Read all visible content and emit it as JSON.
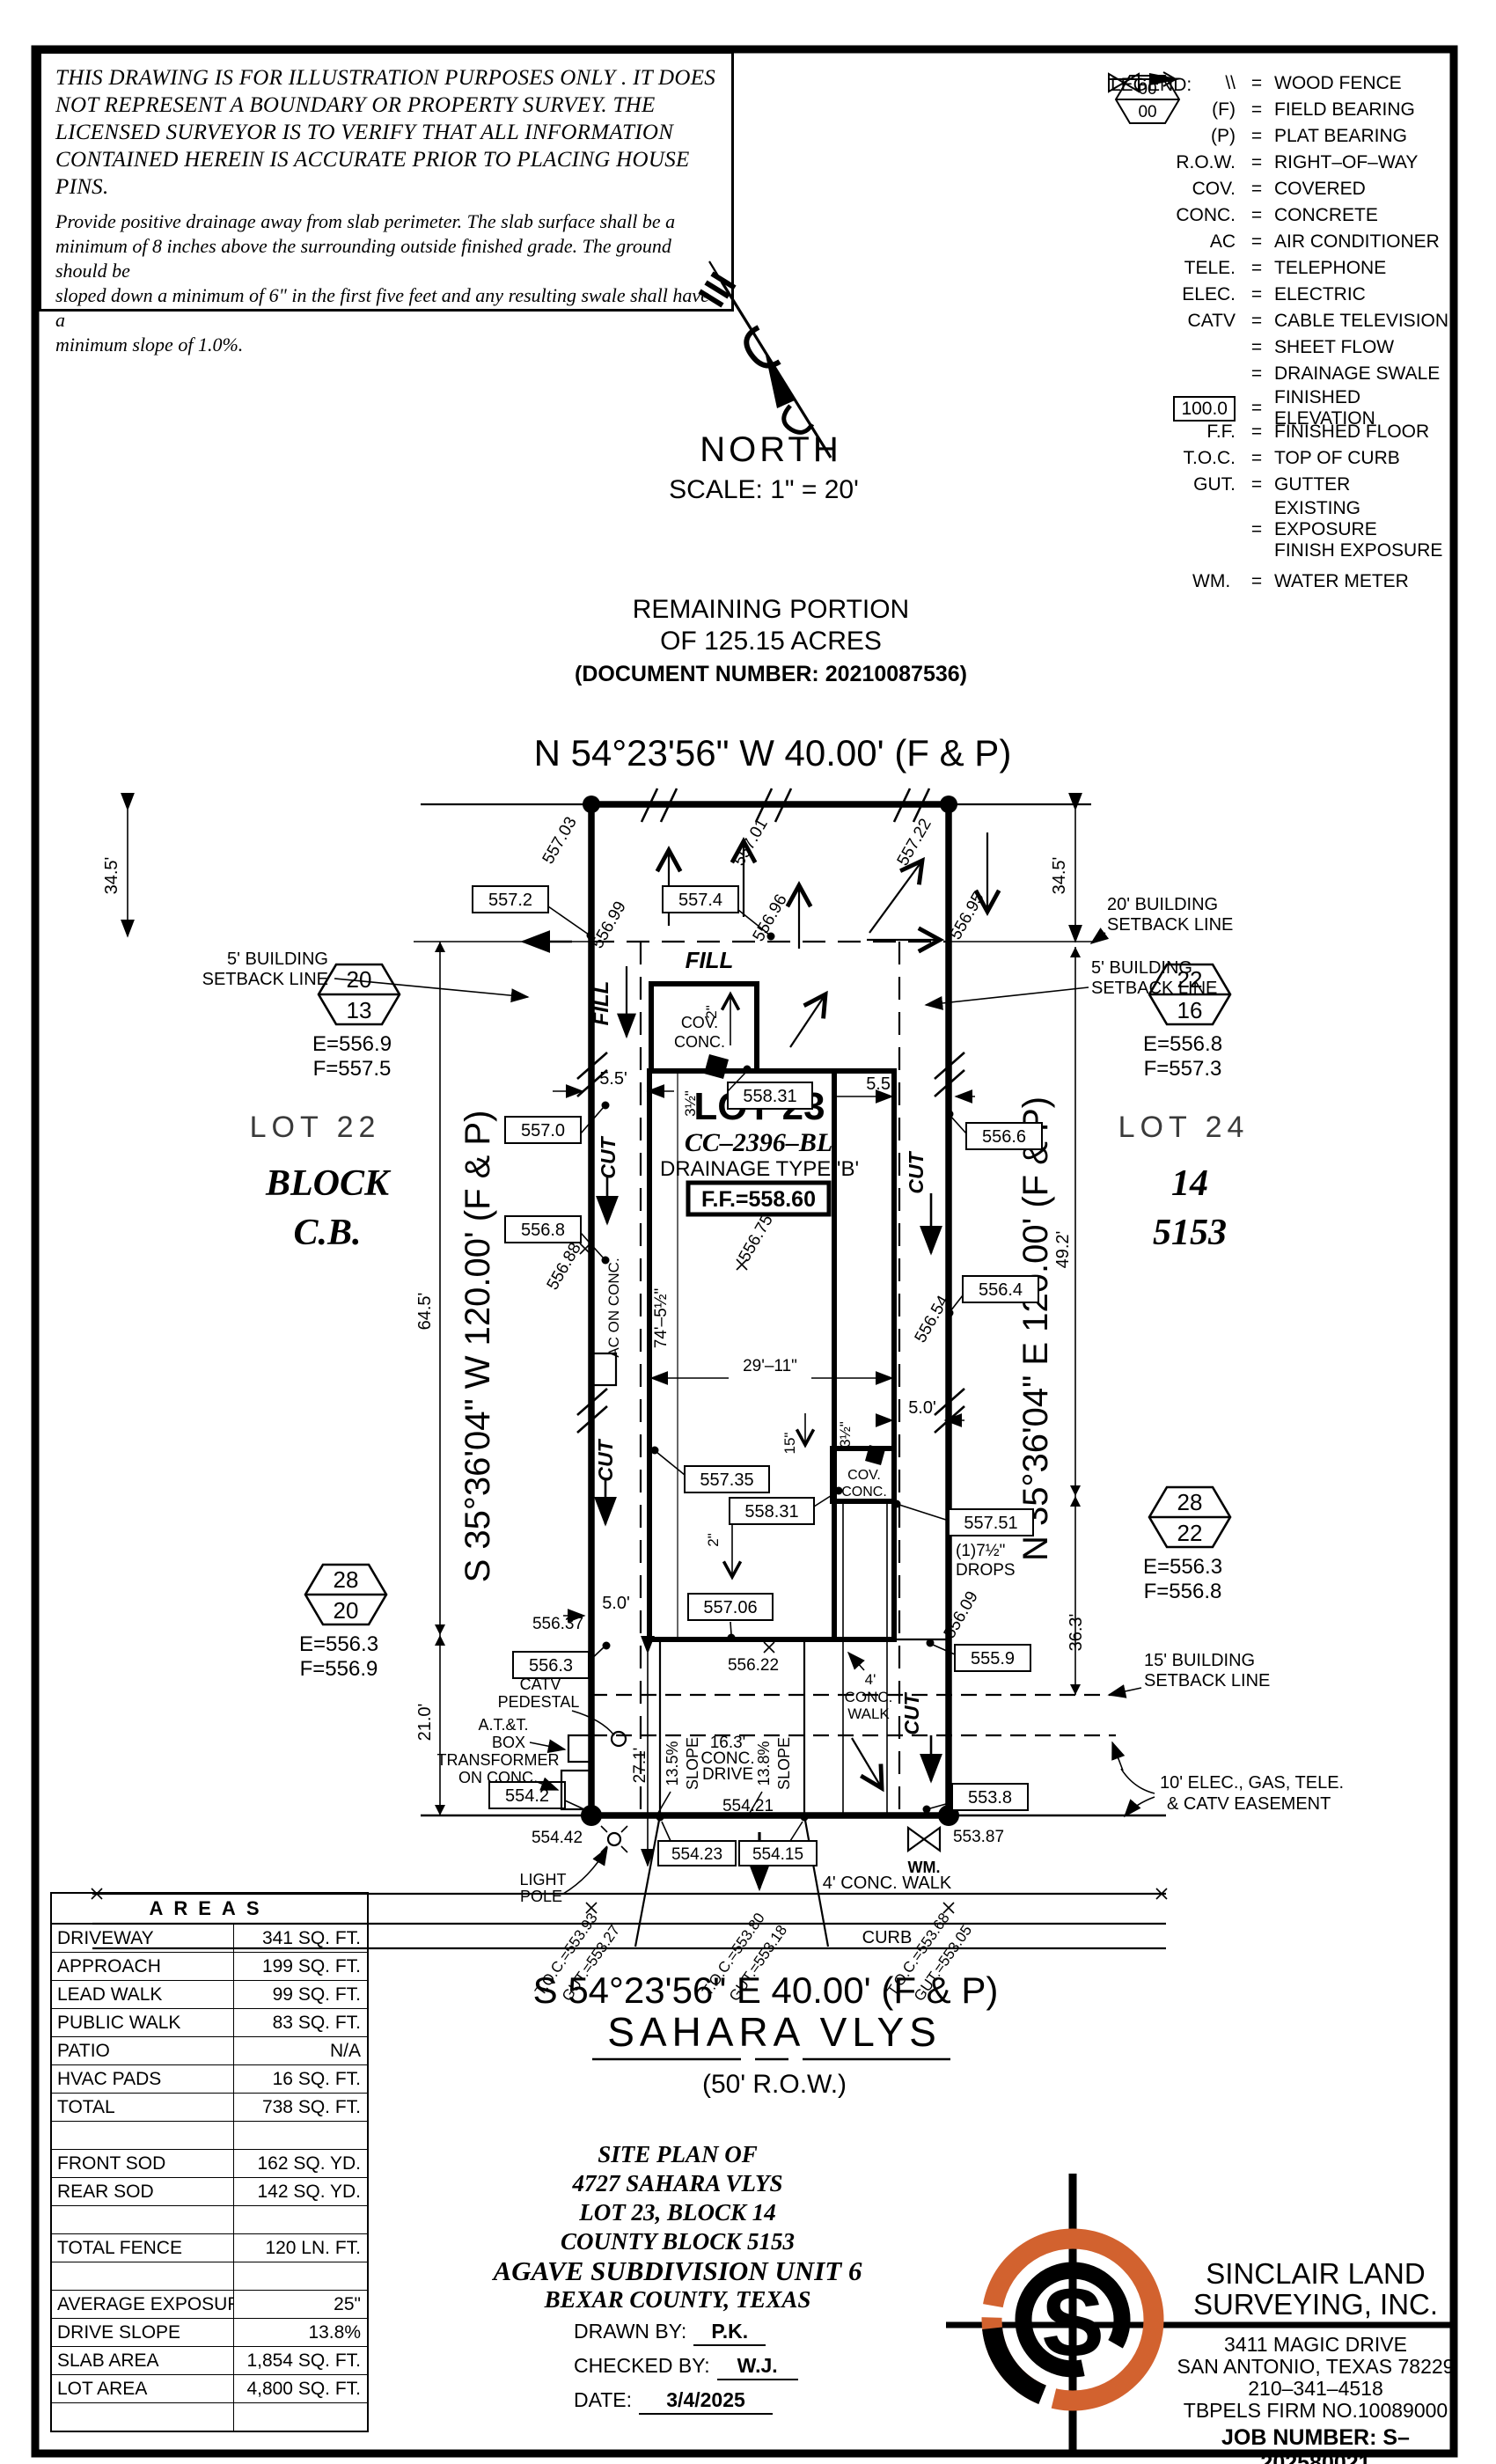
{
  "disclaimer": {
    "h1": "THIS DRAWING IS FOR ILLUSTRATION PURPOSES ONLY . IT DOES",
    "h2": "NOT REPRESENT A BOUNDARY OR PROPERTY SURVEY. THE",
    "h3": "LICENSED SURVEYOR IS TO VERIFY THAT ALL INFORMATION",
    "h4": "CONTAINED HEREIN IS ACCURATE PRIOR TO PLACING HOUSE PINS.",
    "n1": "Provide positive drainage away from slab perimeter. The slab surface shall be a",
    "n2": "minimum of 8 inches above the surrounding outside finished grade. The ground should be",
    "n3": "sloped down a minimum of 6\" in the first five feet and any resulting swale shall have a",
    "n4": "minimum slope of 1.0%."
  },
  "legend": {
    "title": "LEGEND:",
    "eq": "=",
    "items": [
      {
        "sym": "\\\\",
        "label": "WOOD FENCE"
      },
      {
        "sym": "(F)",
        "label": "FIELD BEARING"
      },
      {
        "sym": "(P)",
        "label": "PLAT BEARING"
      },
      {
        "sym": "R.O.W.",
        "label": "RIGHT–OF–WAY"
      },
      {
        "sym": "COV.",
        "label": "COVERED"
      },
      {
        "sym": "CONC.",
        "label": "CONCRETE"
      },
      {
        "sym": "AC",
        "label": "AIR CONDITIONER"
      },
      {
        "sym": "TELE.",
        "label": "TELEPHONE"
      },
      {
        "sym": "ELEC.",
        "label": "ELECTRIC"
      },
      {
        "sym": "CATV",
        "label": "CABLE TELEVISION"
      },
      {
        "sym": "",
        "label": "SHEET FLOW"
      },
      {
        "sym": "",
        "label": "DRAINAGE SWALE"
      },
      {
        "sym": "100.0",
        "label": "FINISHED ELEVATION"
      },
      {
        "sym": "F.F.",
        "label": "FINISHED FLOOR"
      },
      {
        "sym": "T.O.C.",
        "label": "TOP OF CURB"
      },
      {
        "sym": "GUT.",
        "label": "GUTTER"
      },
      {
        "sym": "00",
        "sym2": "00",
        "label": "EXISTING EXPOSURE",
        "label2": "FINISH EXPOSURE"
      },
      {
        "sym": "WM.",
        "label": "WATER METER"
      }
    ]
  },
  "north": {
    "label": "NORTH",
    "scale": "SCALE:  1\" =  20'"
  },
  "remaining": {
    "l1": "REMAINING  PORTION",
    "l2": "OF  125.15  ACRES",
    "l3": "(DOCUMENT  NUMBER: 20210087536)"
  },
  "bearing": {
    "top": "N  54°23'56\"  W  40.00'  (F  &  P)",
    "bottom": "S  54°23'56\"  E  40.00'  (F  &  P)",
    "left": "S  35°36'04\"  W  120.00'  (F  &  P)",
    "right": "N  35°36'04\"  E  120.00'  (F  &  P)"
  },
  "street": {
    "name": "SAHARA  VLYS",
    "row": "(50'  R.O.W.)"
  },
  "lot23": {
    "name": "LOT 23",
    "cc": "CC–2396–BL",
    "drain": "DRAINAGE  TYPE  'B'",
    "ff": "F.F.=558.60"
  },
  "lot22": {
    "name": "LOT 22",
    "l2": "BLOCK",
    "l3": "C.B."
  },
  "lot24": {
    "name": "LOT 24",
    "l2": "14",
    "l3": "5153"
  },
  "hex": {
    "tl": {
      "a": "20",
      "b": "13",
      "e": "E=556.9",
      "f": "F=557.5"
    },
    "tr": {
      "a": "22",
      "b": "16",
      "e": "E=556.8",
      "f": "F=557.3"
    },
    "bl": {
      "a": "28",
      "b": "20",
      "e": "E=556.3",
      "f": "F=556.9"
    },
    "br": {
      "a": "28",
      "b": "22",
      "e": "E=556.3",
      "f": "F=556.8"
    }
  },
  "box": {
    "b5572": "557.2",
    "b5574": "557.4",
    "b5570": "557.0",
    "b5568": "556.8",
    "b55831t": "558.31",
    "b5566": "556.6",
    "b5564": "556.4",
    "b55735": "557.35",
    "b55831m": "558.31",
    "b55751": "557.51",
    "b55706": "557.06",
    "b5563": "556.3",
    "b5559": "555.9",
    "b5542": "554.2",
    "b5538": "553.8",
    "b55423": "554.23",
    "b55415": "554.15"
  },
  "elev": {
    "e55703": "557.03",
    "e55701": "557.01",
    "e55722": "557.22",
    "e55699": "556.99",
    "e55696": "556.96",
    "e55695": "556.95",
    "e55688": "556.88",
    "e55675": "556.75",
    "e55654": "556.54",
    "e55637": "556.37",
    "e55609": "556.09",
    "e55622": "556.22",
    "e55442": "554.42",
    "e55421": "554.21",
    "e55387": "553.87"
  },
  "sb": {
    "l1": "5' BUILDING",
    "l2": "SETBACK LINE",
    "r1": "5' BUILDING",
    "r2": "SETBACK LINE",
    "t1": "20' BUILDING",
    "t2": "SETBACK LINE",
    "b1": "15' BUILDING",
    "b2": "SETBACK LINE",
    "e1": "10' ELEC., GAS, TELE.",
    "e2": "& CATV EASEMENT"
  },
  "dim": {
    "d345l": "34.5'",
    "d345r": "34.5'",
    "d55l": "5.5'",
    "d55r": "5.5'",
    "d50l": "5.0'",
    "d50r": "5.0'",
    "d645": "64.5'",
    "d492": "49.2'",
    "d363": "36.3'",
    "d210": "21.0'",
    "d271": "27.1'",
    "d745": "74'–5½\"",
    "d2911": "29'–11\"",
    "d15": "15\"",
    "d35a": "3½\"",
    "d35b": "3½\"",
    "d2a": "2\"",
    "d2b": "2\"",
    "drops1": "(1)7½\"",
    "drops2": "DROPS",
    "s135": "13.5%",
    "s138": "13.8%",
    "slope": "SLOPE"
  },
  "feat": {
    "fillh": "FILL",
    "fillv": "FILL",
    "cut": "CUT",
    "cov1": "COV.",
    "conc1": "CONC.",
    "cov2": "COV.",
    "conc2": "CONC.",
    "ac": "AC ON CONC.",
    "catv1": "CATV",
    "catv2": "PEDESTAL",
    "att1": "A.T.&T.",
    "att2": "BOX",
    "att3": "TRANSFORMER",
    "att4": "ON CONC.",
    "lp1": "LIGHT",
    "lp2": "POLE",
    "wm": "WM.",
    "w41": "4'",
    "w42": "CONC.",
    "w43": "WALK",
    "walk": "4'  CONC.  WALK",
    "curb": "CURB",
    "d163": "16.3'",
    "d163b": "CONC.",
    "d163c": "DRIVE"
  },
  "toc": {
    "l1": "T.O.C.=553.93",
    "l2": "GUT.=553.27",
    "m1": "T.O.C.=553.80",
    "m2": "GUT.=553.18",
    "r1": "T.O.C.=553.68",
    "r2": "GUT.=553.05"
  },
  "areas": {
    "title": "AREAS",
    "rows": [
      [
        "DRIVEWAY",
        "341 SQ. FT."
      ],
      [
        "APPROACH",
        "199 SQ. FT."
      ],
      [
        "LEAD WALK",
        "99 SQ. FT."
      ],
      [
        "PUBLIC WALK",
        "83 SQ. FT."
      ],
      [
        "PATIO",
        "N/A"
      ],
      [
        "HVAC PADS",
        "16 SQ. FT."
      ],
      [
        "TOTAL",
        "738 SQ. FT."
      ],
      [
        "",
        ""
      ],
      [
        "FRONT SOD",
        "162 SQ. YD."
      ],
      [
        "REAR SOD",
        "142 SQ. YD."
      ],
      [
        "",
        ""
      ],
      [
        "TOTAL FENCE",
        "120 LN. FT."
      ],
      [
        "",
        ""
      ],
      [
        "AVERAGE EXPOSURE",
        "25\""
      ],
      [
        "DRIVE SLOPE",
        "13.8%"
      ],
      [
        "SLAB AREA",
        "1,854 SQ. FT."
      ],
      [
        "LOT AREA",
        "4,800 SQ. FT."
      ],
      [
        "",
        ""
      ]
    ]
  },
  "titleblock": {
    "t1": "SITE  PLAN  OF",
    "t2": "4727  SAHARA  VLYS",
    "t3": "LOT  23,  BLOCK  14",
    "t4": "COUNTY  BLOCK  5153",
    "t5": "AGAVE  SUBDIVISION  UNIT  6",
    "t6": "BEXAR  COUNTY,  TEXAS",
    "drawn_l": "DRAWN  BY:",
    "drawn": "P.K.",
    "check_l": "CHECKED  BY:",
    "check": "W.J.",
    "date_l": "DATE:",
    "date": "3/4/2025"
  },
  "company": {
    "n1": "SINCLAIR  LAND",
    "n2": "SURVEYING,  INC.",
    "a1": "3411  MAGIC  DRIVE",
    "a2": "SAN  ANTONIO,  TEXAS  78229",
    "a3": "210–341–4518",
    "a4": "TBPELS  FIRM  NO.10089000",
    "job": "JOB  NUMBER:   S–202580021",
    "s": "S"
  },
  "colors": {
    "accent": "#d2622f",
    "ink": "#000000"
  }
}
